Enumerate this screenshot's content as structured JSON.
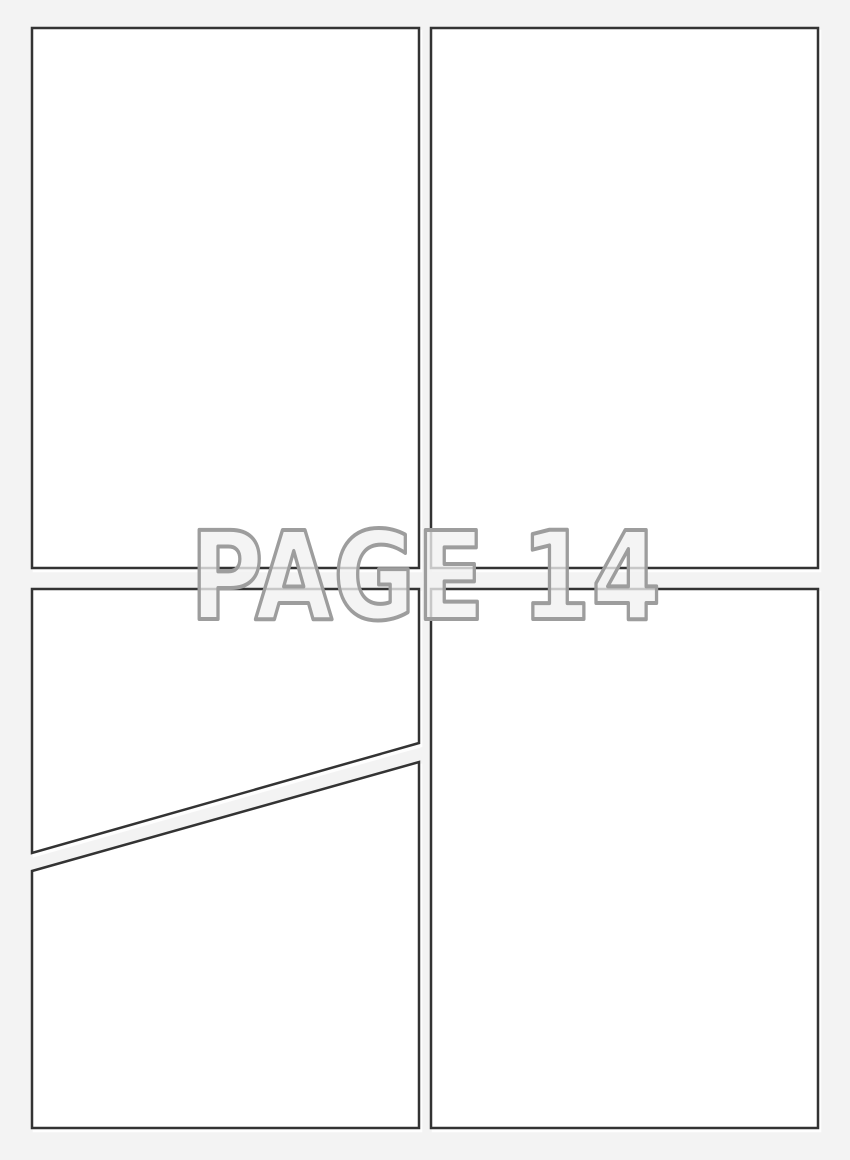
{
  "page": {
    "label": "PAGE 14",
    "panel_count": 5,
    "description": "blank comic page template with five empty panels"
  },
  "colors": {
    "background": "#f3f3f3",
    "panel_fill": "#ffffff",
    "panel_border": "#333333",
    "label_fill": "#f1f1f1",
    "label_outline": "#9d9d9d"
  }
}
